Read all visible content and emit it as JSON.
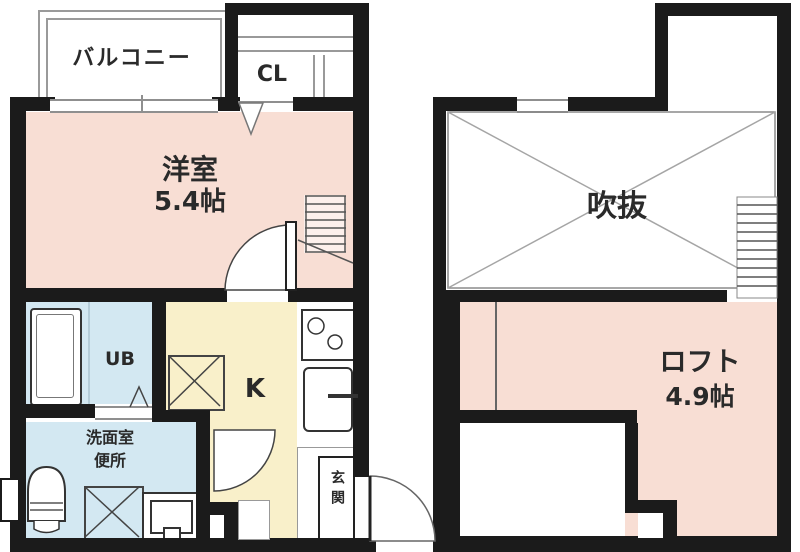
{
  "colors": {
    "wall": "#1b1b1b",
    "room_pink": "#f8ded4",
    "kitchen_yellow": "#f9f0ca",
    "bath_blue": "#d3e8f2",
    "line_gray": "#8f8f8f",
    "text": "#2a2a2a"
  },
  "floor1": {
    "balcony": "バルコニー",
    "closet": "CL",
    "room_name": "洋室",
    "room_size": "5.4帖",
    "unit_bath": "UB",
    "kitchen": "K",
    "washroom_line1": "洗面室",
    "washroom_line2": "便所",
    "entrance": "玄関"
  },
  "floor2": {
    "void": "吹抜",
    "loft_name": "ロフト",
    "loft_size": "4.9帖"
  }
}
